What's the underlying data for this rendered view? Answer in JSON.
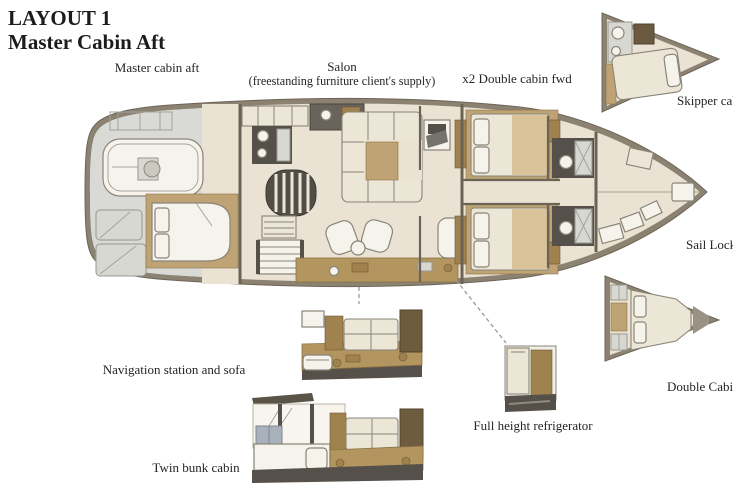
{
  "title": {
    "line1": "LAYOUT 1",
    "line2": "Master Cabin Aft"
  },
  "annotations": {
    "master_cabin_aft": "Master cabin aft",
    "salon_line1": "Salon",
    "salon_line2": "(freestanding furniture client's supply)",
    "double_cabin_fwd": "x2 Double cabin fwd",
    "skipper_cabin": "Skipper cabin",
    "sail_locker": "Sail Locker",
    "double_cabin": "Double Cabin",
    "navigation_station_sofa": "Navigation station and sofa",
    "twin_bunk_cabin": "Twin bunk cabin",
    "full_height_refrigerator": "Full height refrigerator"
  },
  "colors": {
    "background": "#ffffff",
    "text": "#252525",
    "hull_border": "#8b8272",
    "hull_stroke": "#6f6557",
    "deck_floor": "#eae3d3",
    "aft_deck_gray": "#d9d9d5",
    "wood_tan": "#bfa375",
    "furniture_cream": "#ece6d6",
    "dark_fixture": "#55504a",
    "cabinet_brown": "#a0824f",
    "counter_tan": "#b3955f",
    "bulkhead": "#6b6356",
    "line": "#8a8478"
  }
}
